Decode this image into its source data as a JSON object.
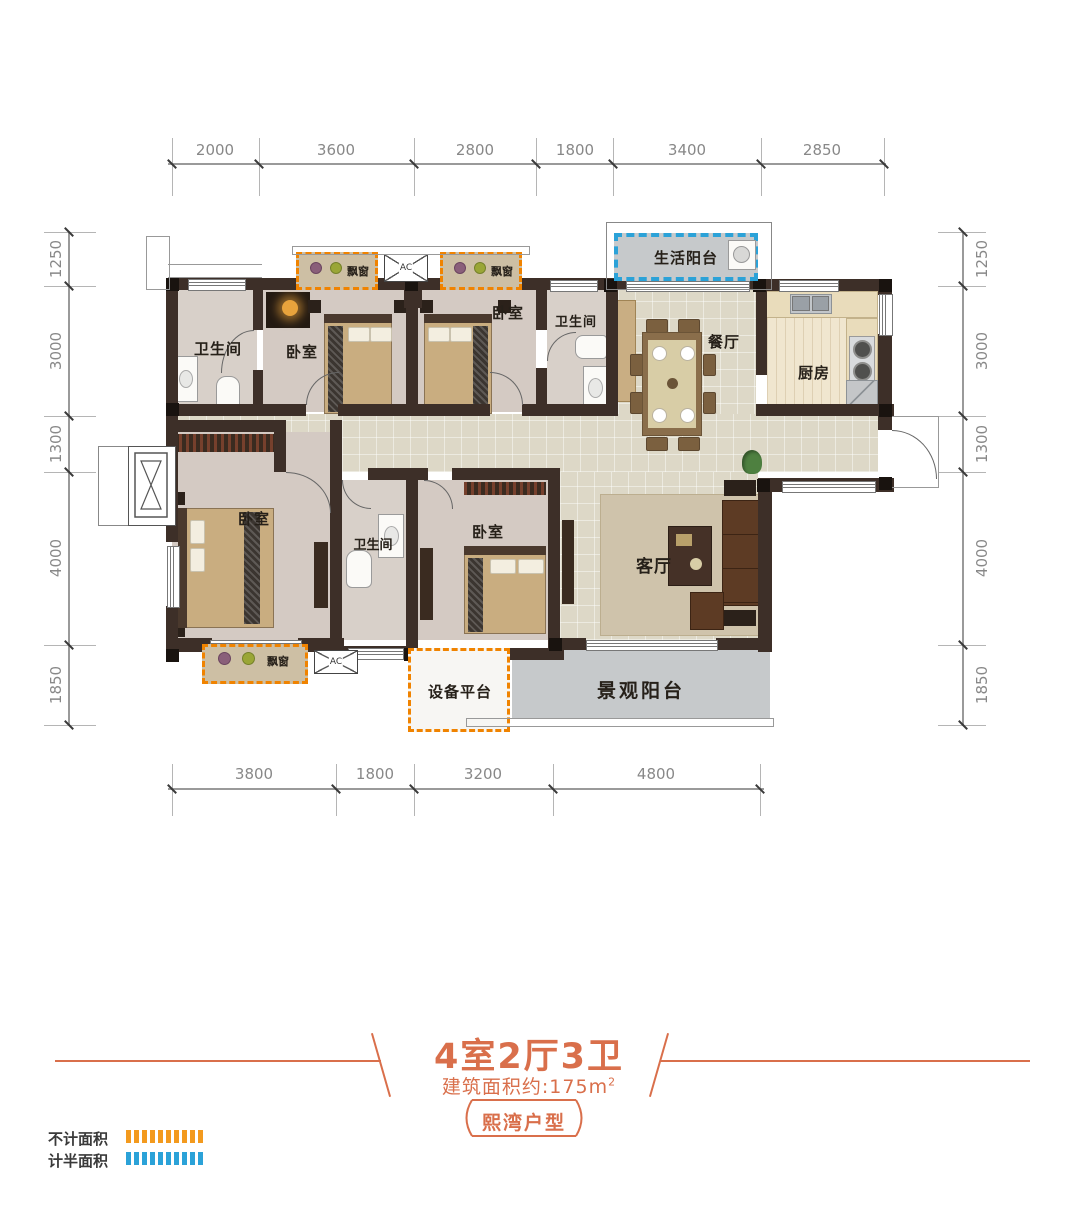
{
  "dimensions": {
    "top": [
      "2000",
      "3600",
      "2800",
      "1800",
      "3400",
      "2850"
    ],
    "bottom": [
      "3800",
      "1800",
      "3200",
      "4800"
    ],
    "left": [
      "1250",
      "3000",
      "1300",
      "4000",
      "1850"
    ],
    "right": [
      "1250",
      "3000",
      "1300",
      "4000",
      "1850"
    ]
  },
  "rooms": {
    "bathroom_top_left": "卫生间",
    "bedroom_top_left": "卧室",
    "bedroom_top_mid": "卧室",
    "bathroom_top_mid": "卫生间",
    "dining": "餐厅",
    "kitchen": "厨房",
    "bedroom_bottom_left": "卧室",
    "bathroom_bottom_mid": "卫生间",
    "bedroom_bottom_mid": "卧室",
    "living": "客厅",
    "life_balcony": "生活阳台",
    "view_balcony": "景观阳台",
    "equipment_platform": "设备平台",
    "bay_window": "飘窗",
    "ac_unit": "AC"
  },
  "title": {
    "headline": "4室2厅3卫",
    "area_text": "建筑面积约:175m",
    "area_sup": "2",
    "badge": "熙湾户型"
  },
  "legend": {
    "no_area": {
      "label": "不计面积",
      "color": "#F39A1E"
    },
    "half_area": {
      "label": "计半面积",
      "color": "#2BA2D8"
    }
  },
  "colors": {
    "wall": "#3D2F28",
    "bay_outline": "#F08300",
    "half_area_outline": "#2BA2D8",
    "accent": "#D96F4B"
  }
}
